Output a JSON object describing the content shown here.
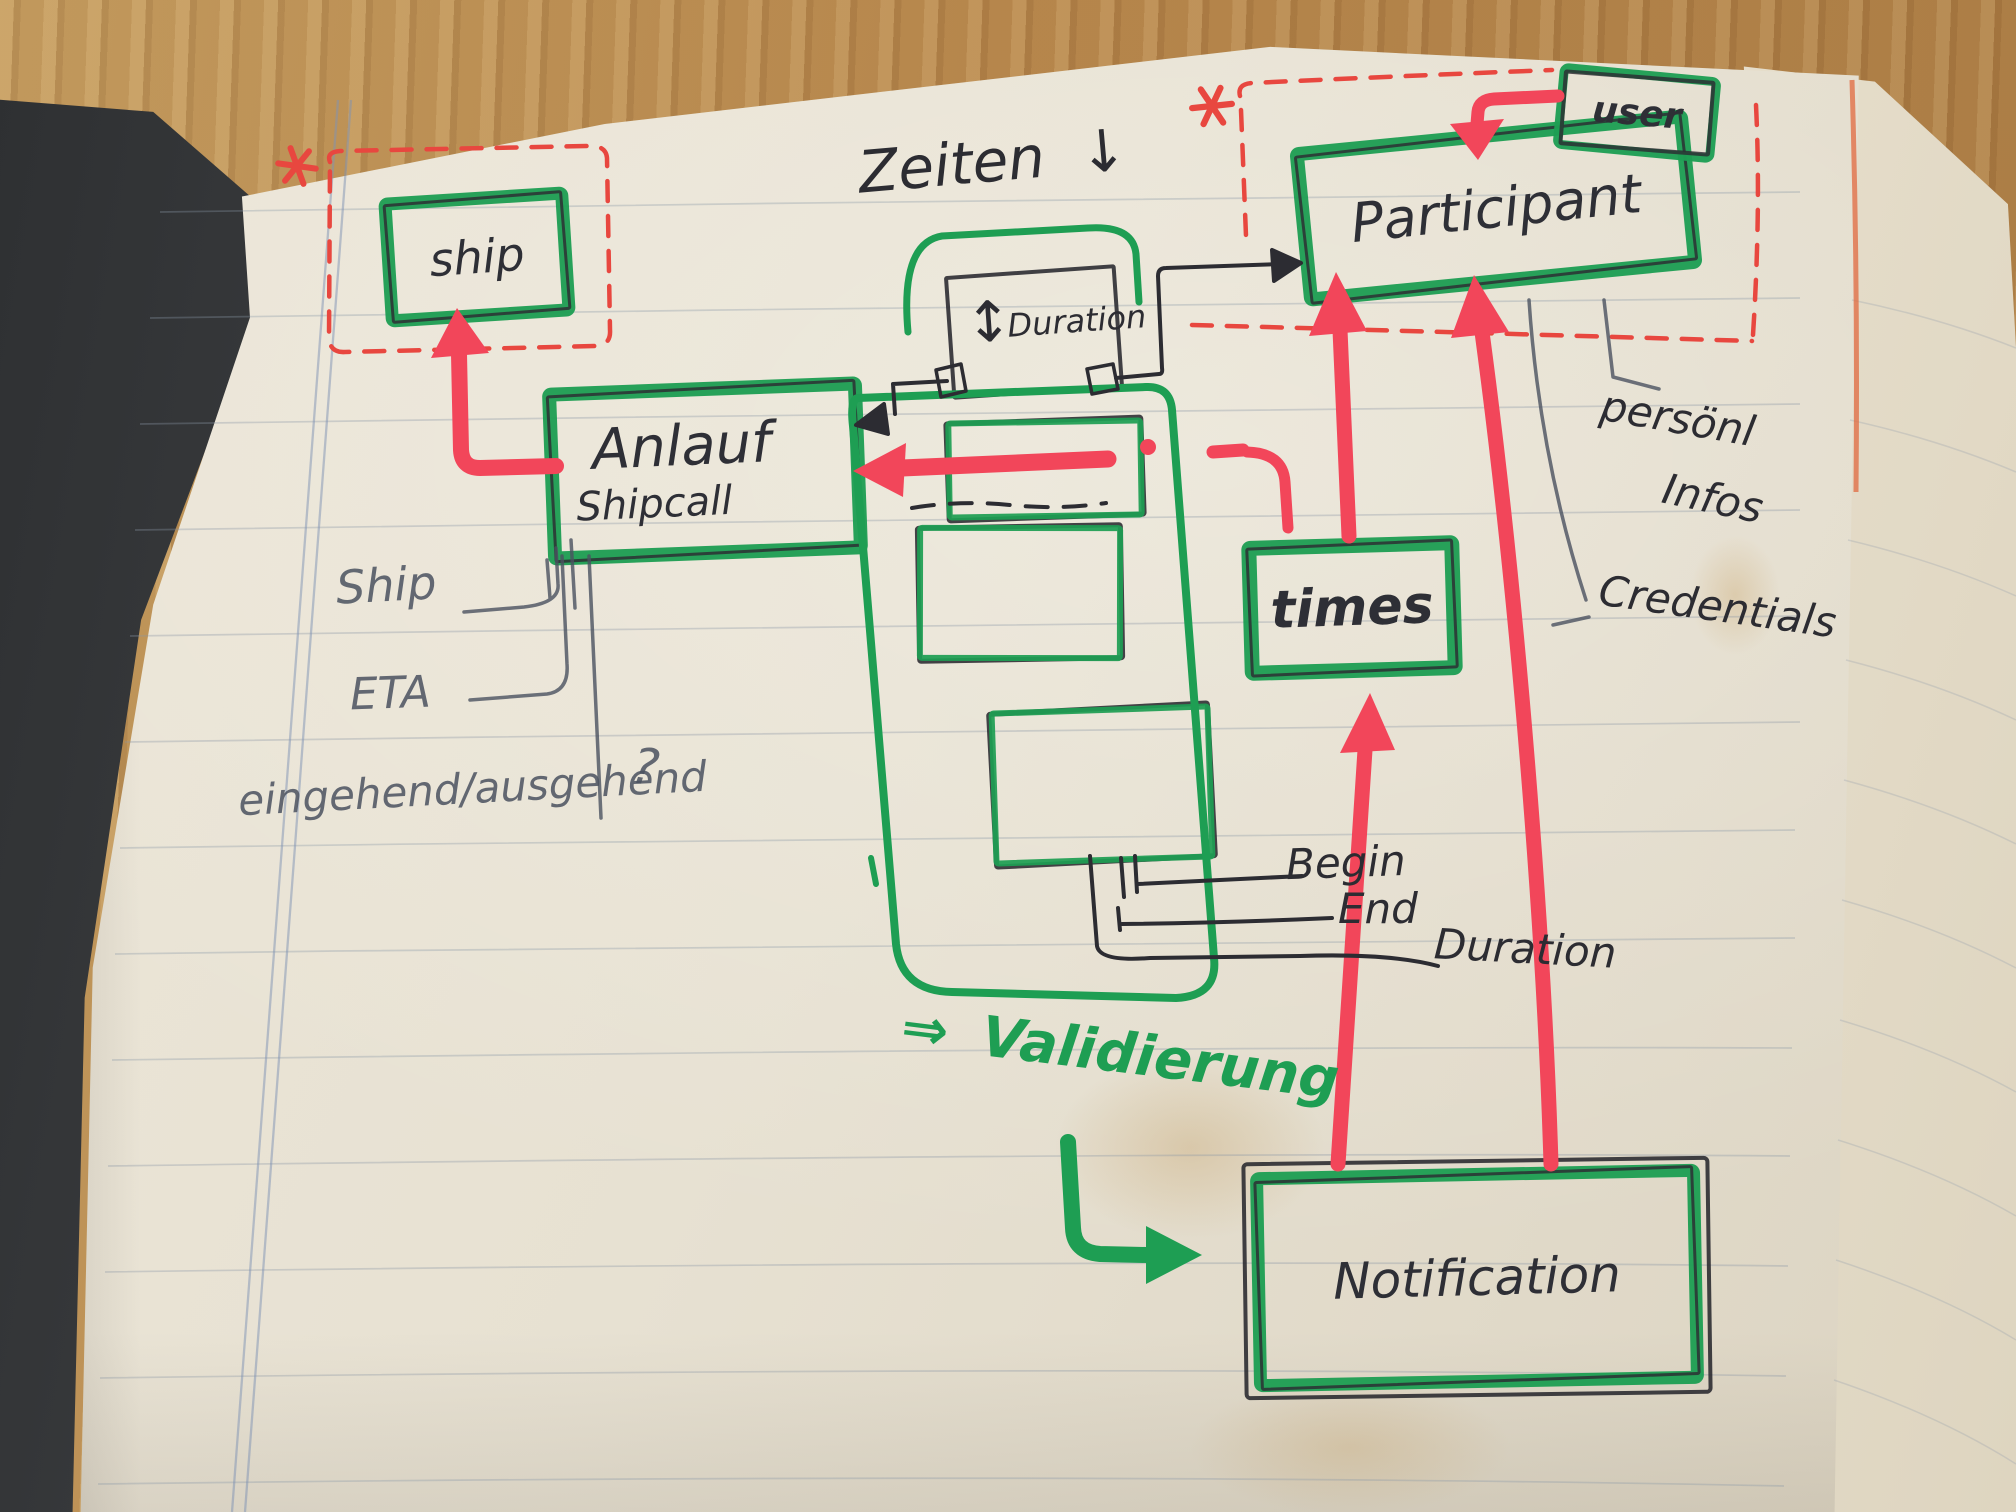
{
  "colors": {
    "green_marker": "#1e9e53",
    "red_marker": "#f2465a",
    "red_pen": "#e8473f",
    "black_pen": "#2c2c32",
    "pencil": "#4b5260",
    "paper": "#e8e2d4",
    "wood": "#b5854b"
  },
  "icons": {
    "down_arrow": "↓",
    "updown_arrow": "↕",
    "double_arrow": "⇒",
    "asterisk": "*"
  },
  "entities": {
    "ship": {
      "label": "ship"
    },
    "shipcall": {
      "line1": "Anlauf",
      "line2": "Shipcall"
    },
    "participant": {
      "label": "Participant"
    },
    "user": {
      "label": "user"
    },
    "times": {
      "label": "times"
    },
    "duration_field": {
      "label": "Duration"
    },
    "notification": {
      "label": "Notification"
    }
  },
  "annotations": {
    "zeiten": "Zeiten",
    "ship_attribute": "Ship",
    "eta_attribute": "ETA",
    "in_out_attribute": "eingehend/ausgehend",
    "question_mark": "?",
    "begin_attribute": "Begin",
    "end_attribute": "End",
    "duration_attribute": "Duration",
    "personal_info_line1": "persönl",
    "personal_info_line2": "Infos",
    "credentials_attribute": "Credentials",
    "validation_note": "Validierung"
  }
}
